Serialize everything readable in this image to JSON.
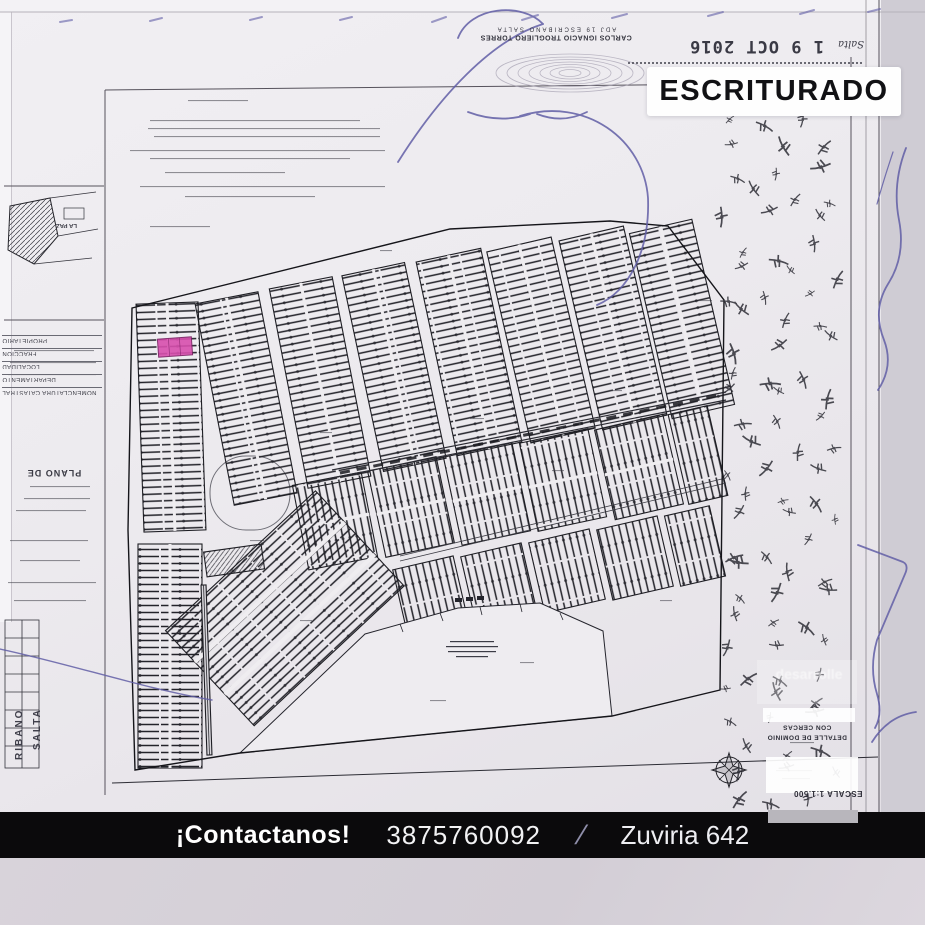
{
  "badge": {
    "label": "ESCRITURADO",
    "bg": "#fefefe",
    "fg": "#111114"
  },
  "notary_stamp": {
    "line1": "CARLOS IGNACIO TROGLIERO TORRES",
    "line2": "ADJ 19  ESCRIBANO  SALTA"
  },
  "date_stamp": {
    "place": "Salta",
    "date": "1 9 OCT 2016"
  },
  "side_panel": {
    "fields": [
      "NOMENCLATURA CATASTRAL",
      "DEPARTAMENTO",
      "LOCALIDAD",
      "FRACCION",
      "PROPIETARIO"
    ],
    "plan_title": "PLANO DE",
    "minimap_label": "LA PAZ",
    "edge_text_top": "RIBANO",
    "edge_text_bottom": "SALTA"
  },
  "plan_labels": {
    "detail_title": "DETALLE DE DOMINIO",
    "detail_subtitle": "CON CERCAS",
    "scale": "ESCALA 1:1.500",
    "watermark": "desarrolle"
  },
  "footer": {
    "cta": "¡Contactanos!",
    "phone": "3875760092",
    "separator": "/",
    "address": "Zuviria 642"
  },
  "colors": {
    "pen_ink": "#615ea6",
    "map_ink": "#1e1e24",
    "highlight_lot": "#d84fae",
    "banner_bg": "#0b0a0c",
    "paper": "#edebef",
    "background": "#d6d1d9"
  }
}
